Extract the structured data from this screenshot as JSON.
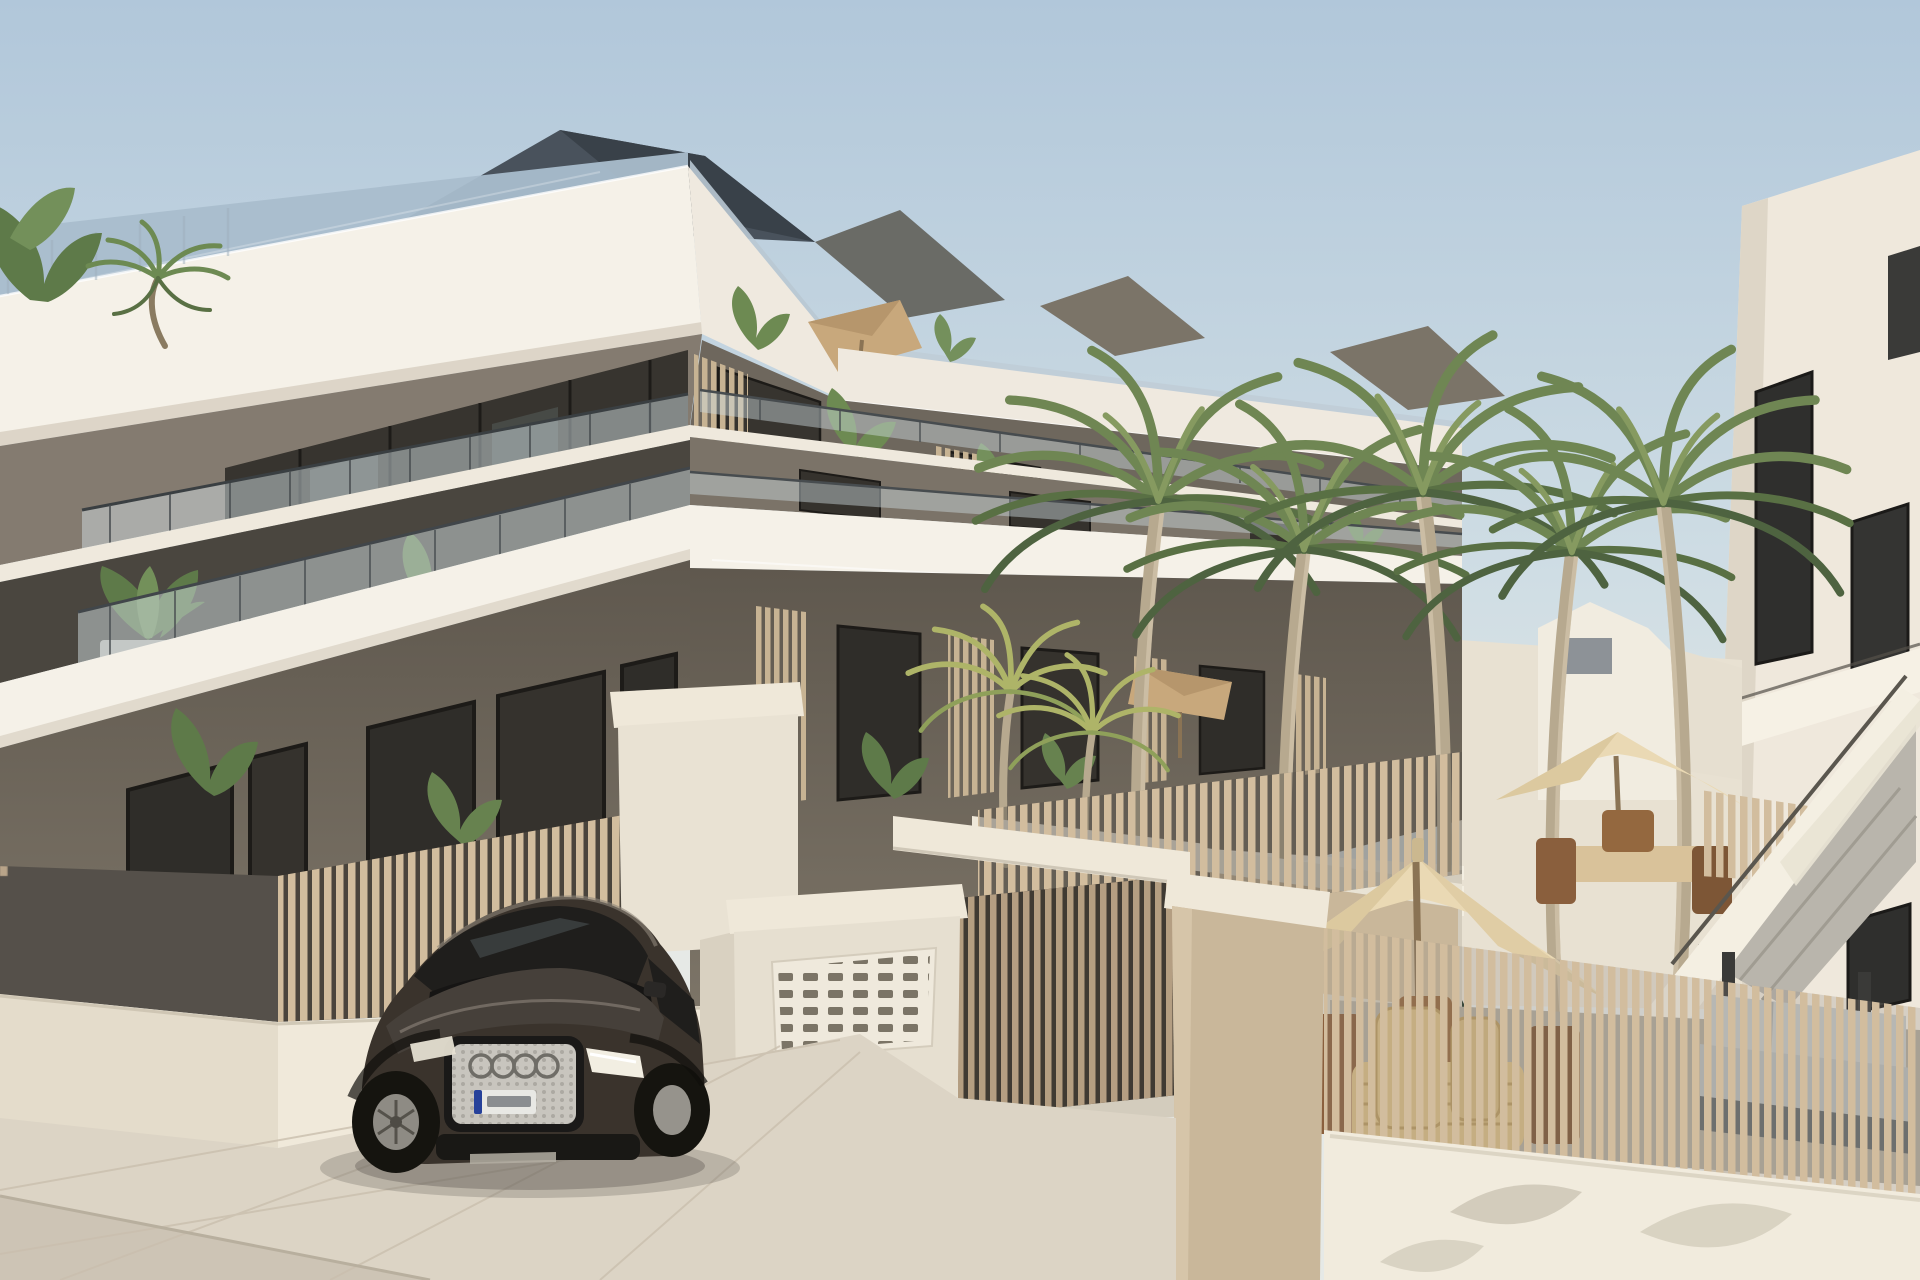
{
  "scene": {
    "label": "Architectural rendering of a modern white three-storey apartment complex with rooftop terraces, wooden slat fences, palm-lined courtyard with umbrellas and stairs, and a dark SUV parked at the entrance"
  },
  "objects": {
    "building_storeys": 3,
    "tall_palm_count": 5,
    "short_palm_count": 2,
    "cream_umbrella_count": 2,
    "tan_parasol_count": 2,
    "car_badge_icon": "audi-rings-icon"
  },
  "palette": {
    "sky_top": "#b1c7da",
    "sky_mid": "#cfdde4",
    "sky_bottom": "#e6e9e6",
    "glass_roof": "#a9bdcc",
    "roof_slate": "#49525c",
    "roof_slate_dark": "#394149",
    "roof_tan": "#7b7468",
    "fascia": "#f5f1e8",
    "fascia_right": "#efe9df",
    "fascia_shade": "#d8d0c2",
    "slab_white": "#efe9dd",
    "wall_taupe": "#847b70",
    "wall_taupe_dark": "#6e675d",
    "wall_ground": "#756d61",
    "glazing": "#37342f",
    "window_dark": "#2f2d29",
    "glass_tint": "#cfdbe0",
    "screen_wood": "#c7b393",
    "fence_wood": "#d2bd9e",
    "fence_wood_shade": "#b9a489",
    "gate_wood": "#b49e82",
    "fence_backdrop": "#55504a",
    "base_wall": "#f0e9da",
    "pavement": "#dcd4c5",
    "road": "#cbc2b2",
    "hedge": "#1f3526",
    "palm_green": "#6f8653",
    "palm_yellow": "#aeb468",
    "trunk": "#b7a98f",
    "pergola_white": "#f3eee1",
    "umbrella_cream": "#ead9b4",
    "parasol_tan": "#c8a87c",
    "pole_wood": "#8a7354",
    "house_white": "#f1ece0",
    "house_window": "#8d9297",
    "stair_white": "#f4efe2",
    "step_grey": "#b9b5ac",
    "rbuilding": "#efe8dc",
    "rwindow": "#2f2f2d",
    "sofa_light": "#c6c8c6",
    "sofa_dark": "#63686a",
    "wicker": "#d8bd84",
    "entry_white": "#efe8d9",
    "pillar_beige": "#c9b79a",
    "mailbox_slot": "#7b7466",
    "chair_white": "#eceade",
    "planter_grey": "#b9b5ad",
    "car_body": "#3a332c",
    "car_glass": "#1f1e1c",
    "grille_silver": "#c8c5be",
    "grille_dark": "#1a1918",
    "ring_grey": "#6f6d67",
    "plate_white": "#e8e8e4",
    "plate_blue": "#26419a",
    "headlight": "#f2eee2",
    "wheel_dark": "#15140f",
    "rim": "#8e8b84",
    "shadow_soft": "#55504a"
  }
}
